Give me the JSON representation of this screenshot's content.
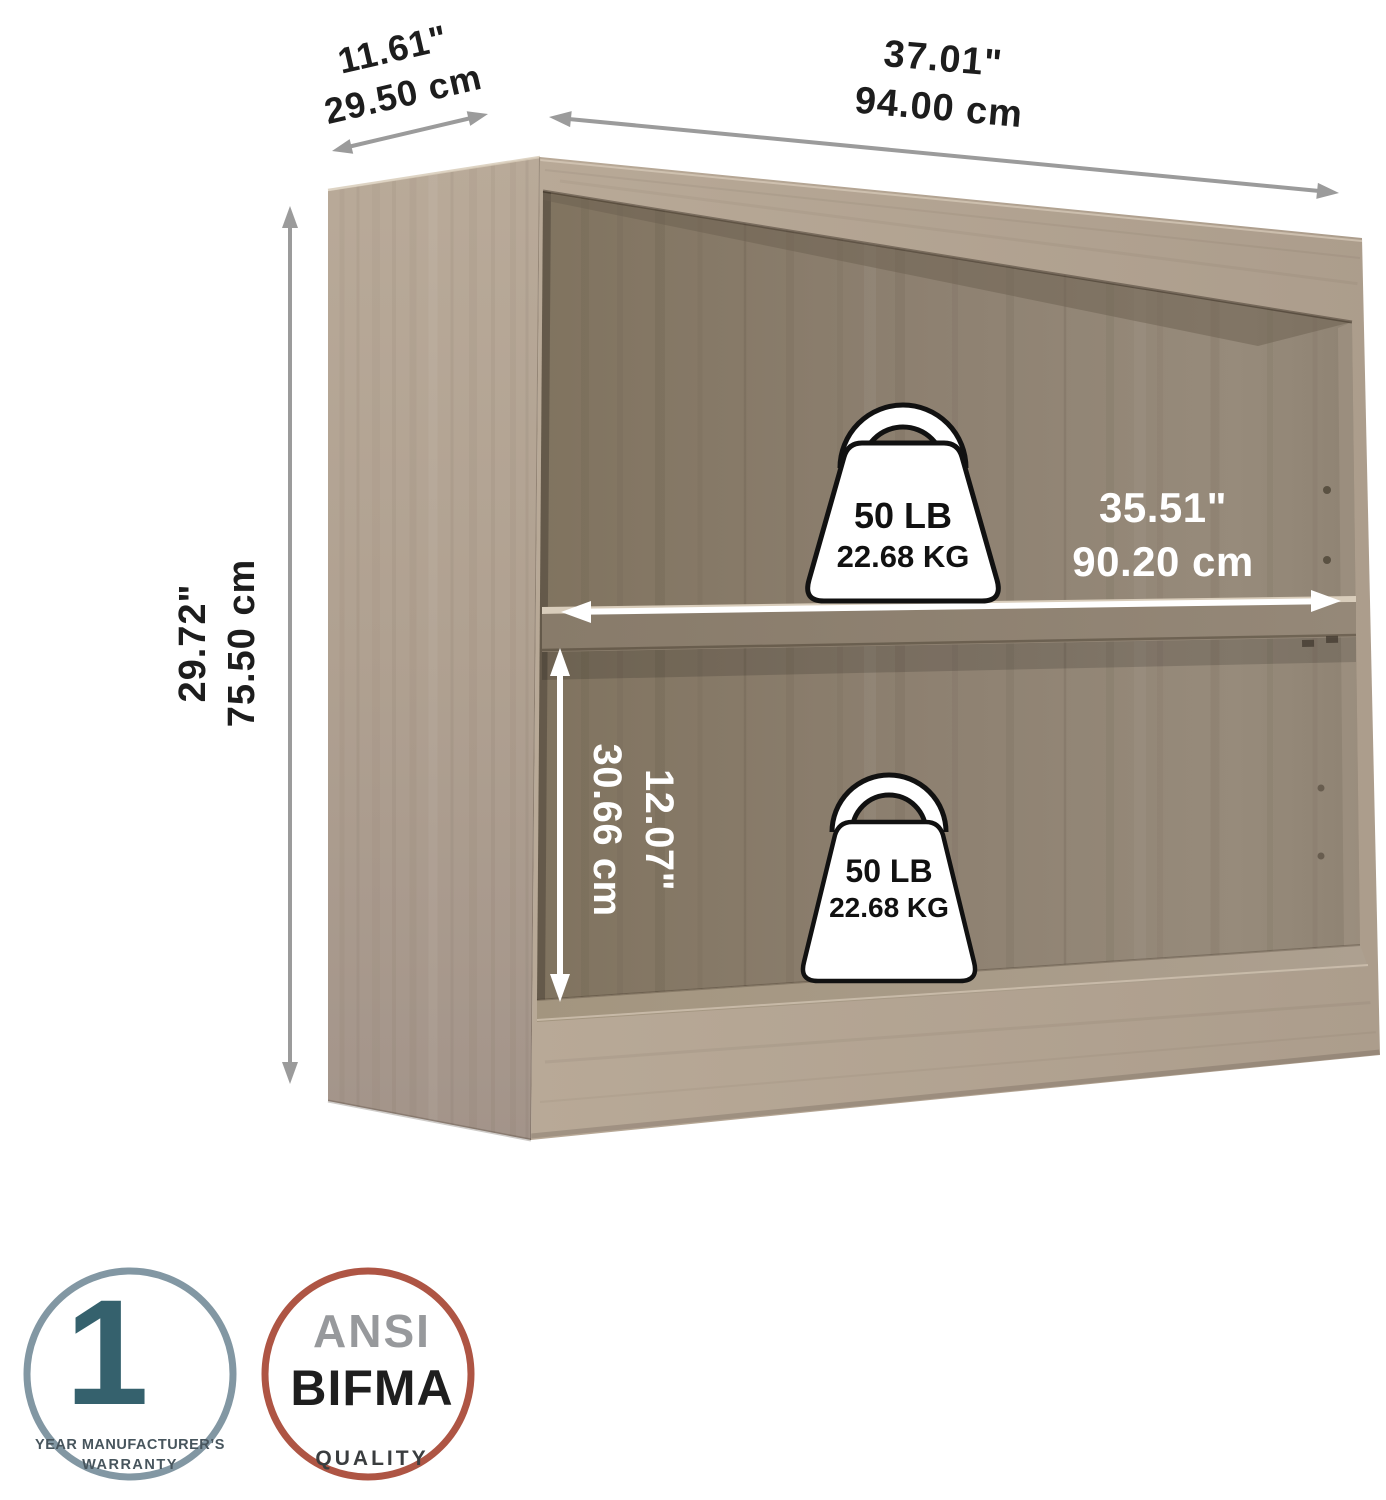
{
  "labels": {
    "depth": {
      "inches": "11.61\"",
      "cm": "29.50 cm"
    },
    "width": {
      "inches": "37.01\"",
      "cm": "94.00 cm"
    },
    "height": {
      "inches": "29.72\"",
      "cm": "75.50 cm"
    },
    "shelf_width": {
      "inches": "35.51\"",
      "cm": "90.20 cm"
    },
    "shelf_opening_height": {
      "inches": "12.07\"",
      "cm": "30.66 cm"
    }
  },
  "capacity": {
    "upper_shelf": {
      "pounds": "50 LB",
      "kilograms": "22.68 KG"
    },
    "lower_shelf": {
      "pounds": "50 LB",
      "kilograms": "22.68 KG"
    }
  },
  "badges": {
    "warranty": {
      "number": "1",
      "line1": "YEAR MANUFACTURER’S",
      "line2": "WARRANTY"
    },
    "quality": {
      "line1": "ANSI",
      "line2": "BIFMA",
      "line3": "QUALITY"
    }
  },
  "colors": {
    "wood_light": "#b4a593",
    "wood_back": "#8d8070",
    "arrow_gray": "#9b9b9b",
    "annotation_black": "#1d1d1d",
    "annotation_white": "#ffffff",
    "warranty_ring": "#8297a3",
    "warranty_accent": "#35616d",
    "quality_ring": "#ae5544",
    "ansi_gray": "#97999c",
    "bifma_black": "#1e1e1e"
  }
}
